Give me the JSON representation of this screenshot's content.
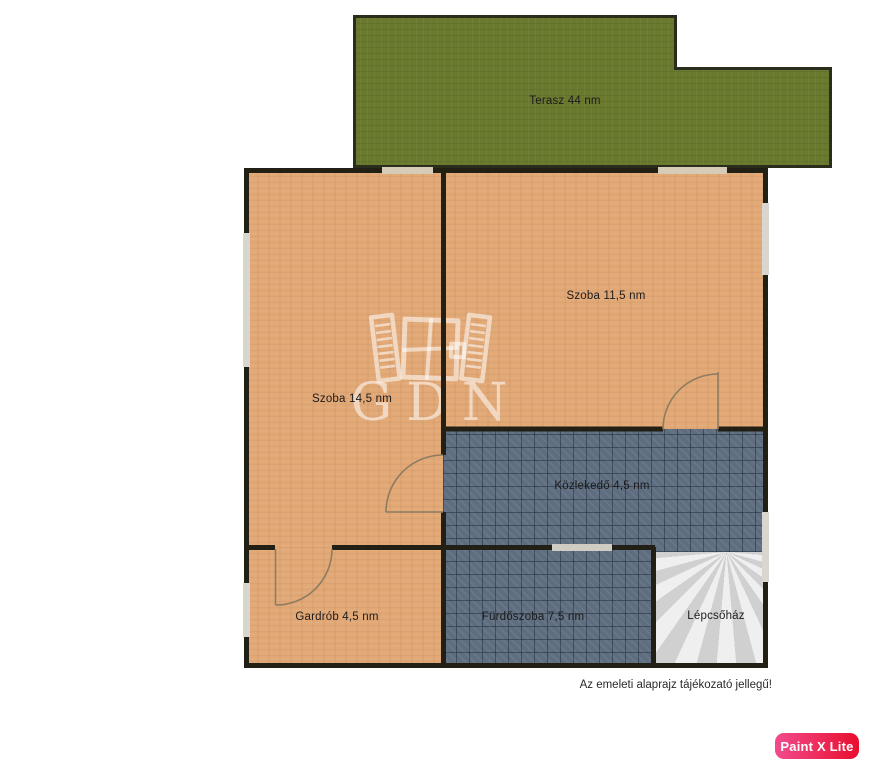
{
  "plan": {
    "rooms": [
      {
        "name": "terasz",
        "label": "Terasz 44 nm"
      },
      {
        "name": "szoba-14-5",
        "label": "Szoba 14,5 nm"
      },
      {
        "name": "szoba-11-5",
        "label": "Szoba 11,5 nm"
      },
      {
        "name": "kozlekedo",
        "label": "Közlekedő 4,5 nm"
      },
      {
        "name": "gardrob",
        "label": "Gardrób 4,5 nm"
      },
      {
        "name": "furdoszoba",
        "label": "Fürdőszoba 7,5 nm"
      },
      {
        "name": "lepcsohaz",
        "label": "Lépcsőház"
      }
    ],
    "note": "Az emeleti alaprajz tájékozató jellegű!"
  },
  "watermark": {
    "text": "GDN"
  },
  "app_badge": {
    "label": "Paint X Lite"
  },
  "colors": {
    "floor_tan": "#e2a876",
    "tile_dark": "#5e6d7f",
    "terrace_green": "#69792e",
    "stair_gray": "#e2e2e2",
    "wall": "#221f14",
    "window_gap": "#d9d6d0",
    "badge_pink": "#f24b8e",
    "badge_red": "#e90e2d"
  }
}
